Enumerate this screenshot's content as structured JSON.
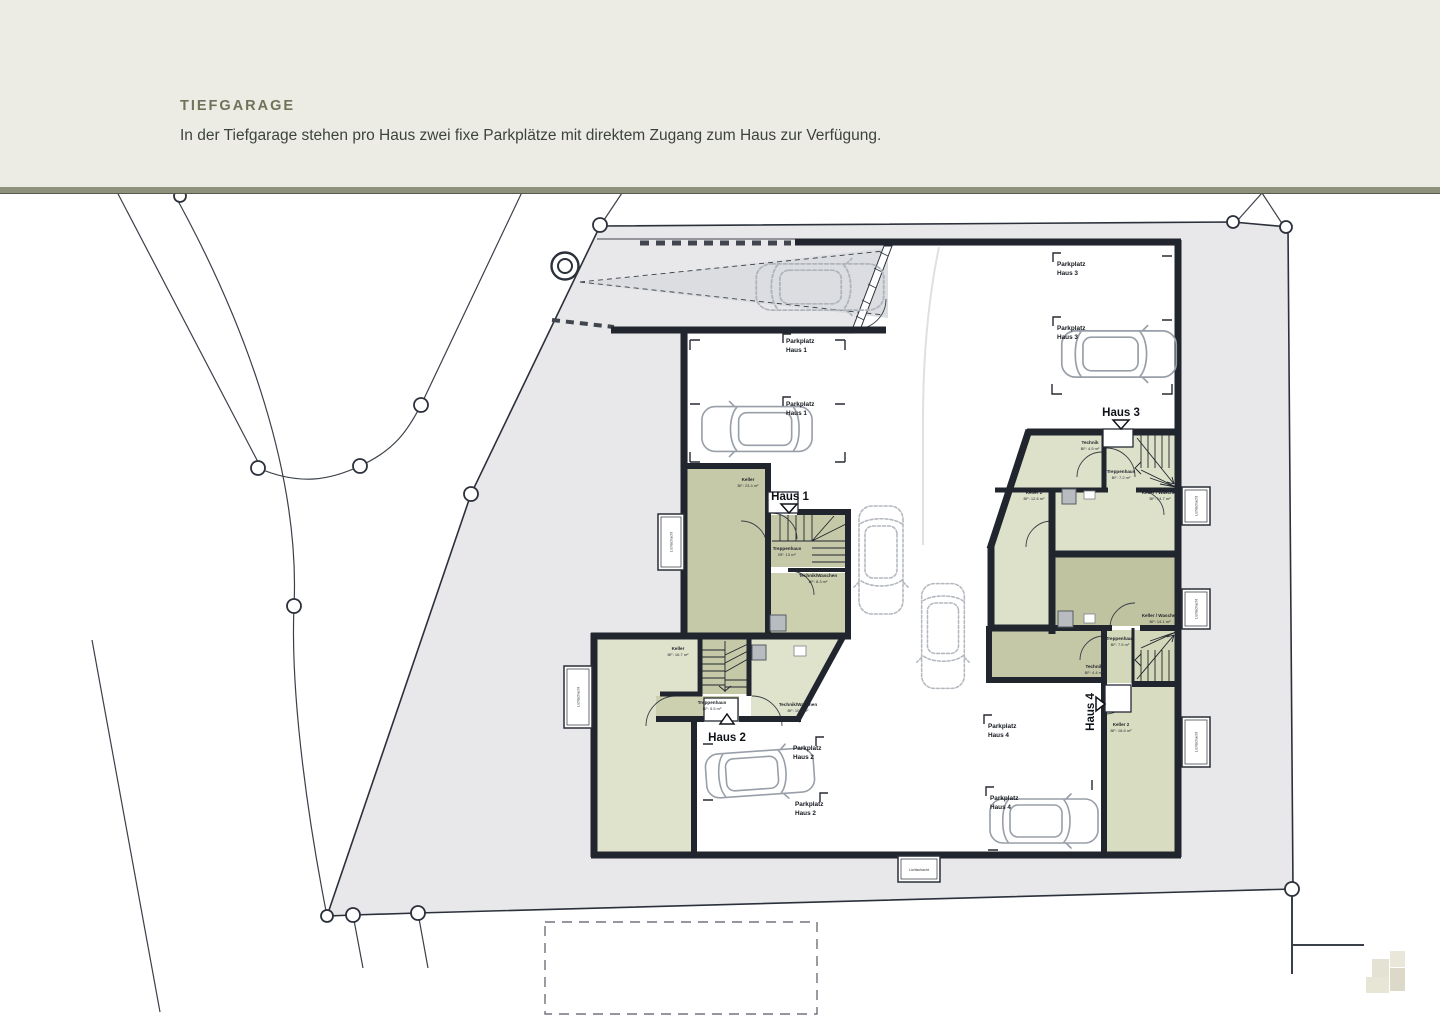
{
  "header": {
    "title": "TIEFGARAGE",
    "subtitle": "In der Tiefgarage stehen pro Haus zwei fixe Parkplätze mit direktem Zugang zum Haus zur Verfügung."
  },
  "plan": {
    "parkplatz_word": "Parkplatz",
    "lichtschacht": "Lichtschacht",
    "haus1": {
      "label": "Haus 1",
      "rooms": {
        "keller": {
          "name": "Keller",
          "area": "BF: 23.4 m²"
        },
        "treppenhaus": {
          "name": "Treppenhaus",
          "area": "BF: 13 m²"
        },
        "technik": {
          "name": "Technik/Waschen",
          "area": "BF: 8.3 m²"
        }
      }
    },
    "haus2": {
      "label": "Haus 2",
      "rooms": {
        "keller": {
          "name": "Keller",
          "area": "BF: 16.7 m²"
        },
        "treppenhaus": {
          "name": "Treppenhaus",
          "area": "BF: 5.5 m²"
        },
        "technik": {
          "name": "Technik/Waschen",
          "area": "BF: 10.3 m²"
        }
      }
    },
    "haus3": {
      "label": "Haus 3",
      "rooms": {
        "technik": {
          "name": "Technik",
          "area": "BF: 4.5 m²"
        },
        "treppenhaus": {
          "name": "Treppenhaus",
          "area": "BF: 7.2 m²"
        },
        "keller2": {
          "name": "Keller 2",
          "area": "BF: 12.6 m²"
        },
        "kellerwaschen": {
          "name": "Keller / Waschen",
          "area": "BF: 14.7 m²"
        }
      }
    },
    "haus4": {
      "label": "Haus 4",
      "rooms": {
        "kellerwaschen": {
          "name": "Keller / Waschen",
          "area": "BF: 14.1 m²"
        },
        "treppenhaus": {
          "name": "Treppenhaus",
          "area": "BF: 7.5 m²"
        },
        "technik": {
          "name": "Technik",
          "area": "BF: 4.4 m²"
        },
        "keller2": {
          "name": "Keller 2",
          "area": "BF: 18.6 m²"
        }
      }
    }
  },
  "colors": {
    "header_bg": "#ecece4",
    "accent_band": "#8e927d",
    "title_text": "#6e7359",
    "wall": "#20252e",
    "parcel": "#e8e8ea",
    "room_olive": "#c6c9a8",
    "room_sage": "#dfe3cc",
    "room_khaki": "#bfc3a0"
  }
}
